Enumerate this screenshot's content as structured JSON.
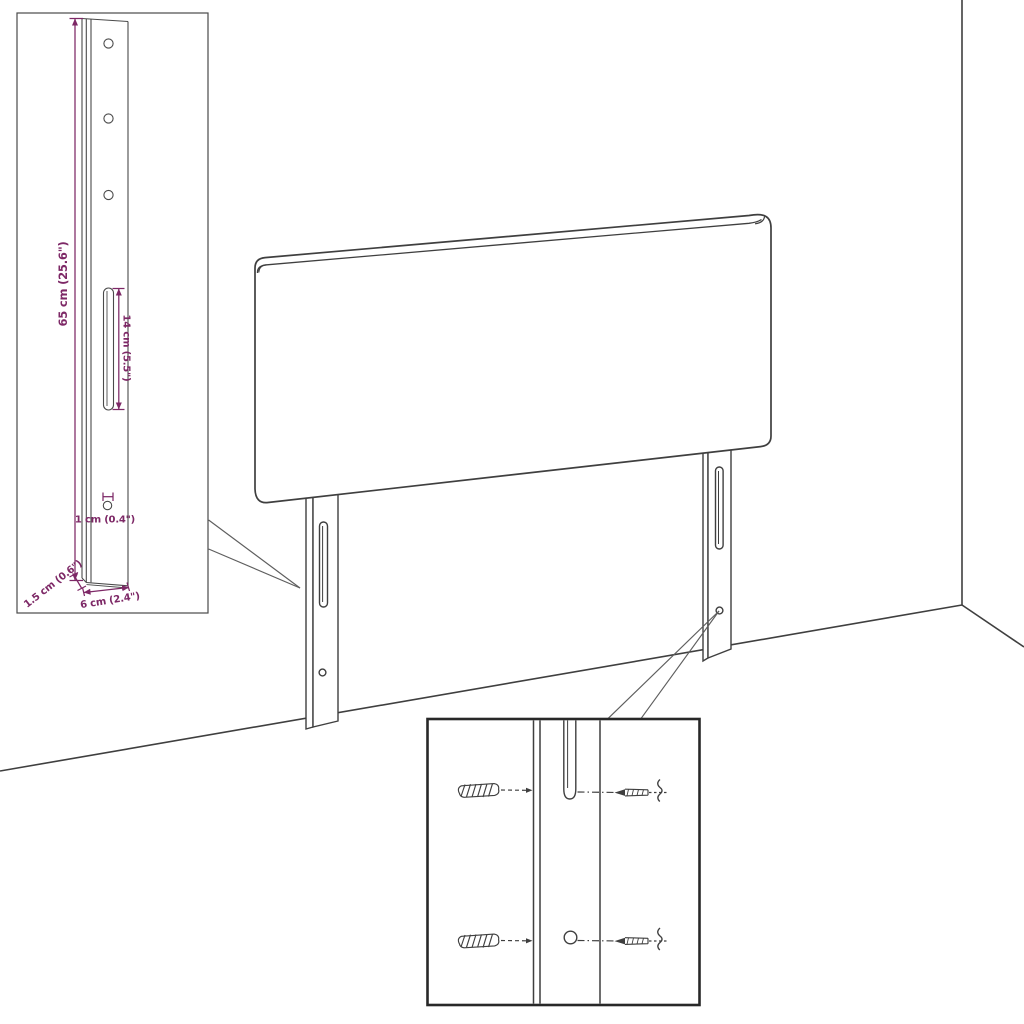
{
  "title": "Headboard with legs - dimension diagram",
  "colors": {
    "outline": "#3f3f3f",
    "dimension": "#7d2866",
    "leader": "#5e5e5e",
    "inset_border_bold": "#282828",
    "inset_border_light": "#4a4a4a",
    "background": "#ffffff"
  },
  "insets": {
    "bracket_detail": {
      "dim_height": "65 cm (25.6\")",
      "dim_slot": "14 cm (5.5\")",
      "dim_hole": "1 cm (0.4\")",
      "dim_depth": "1.5 cm (0.6\")",
      "dim_width": "6 cm (2.4\")"
    }
  }
}
